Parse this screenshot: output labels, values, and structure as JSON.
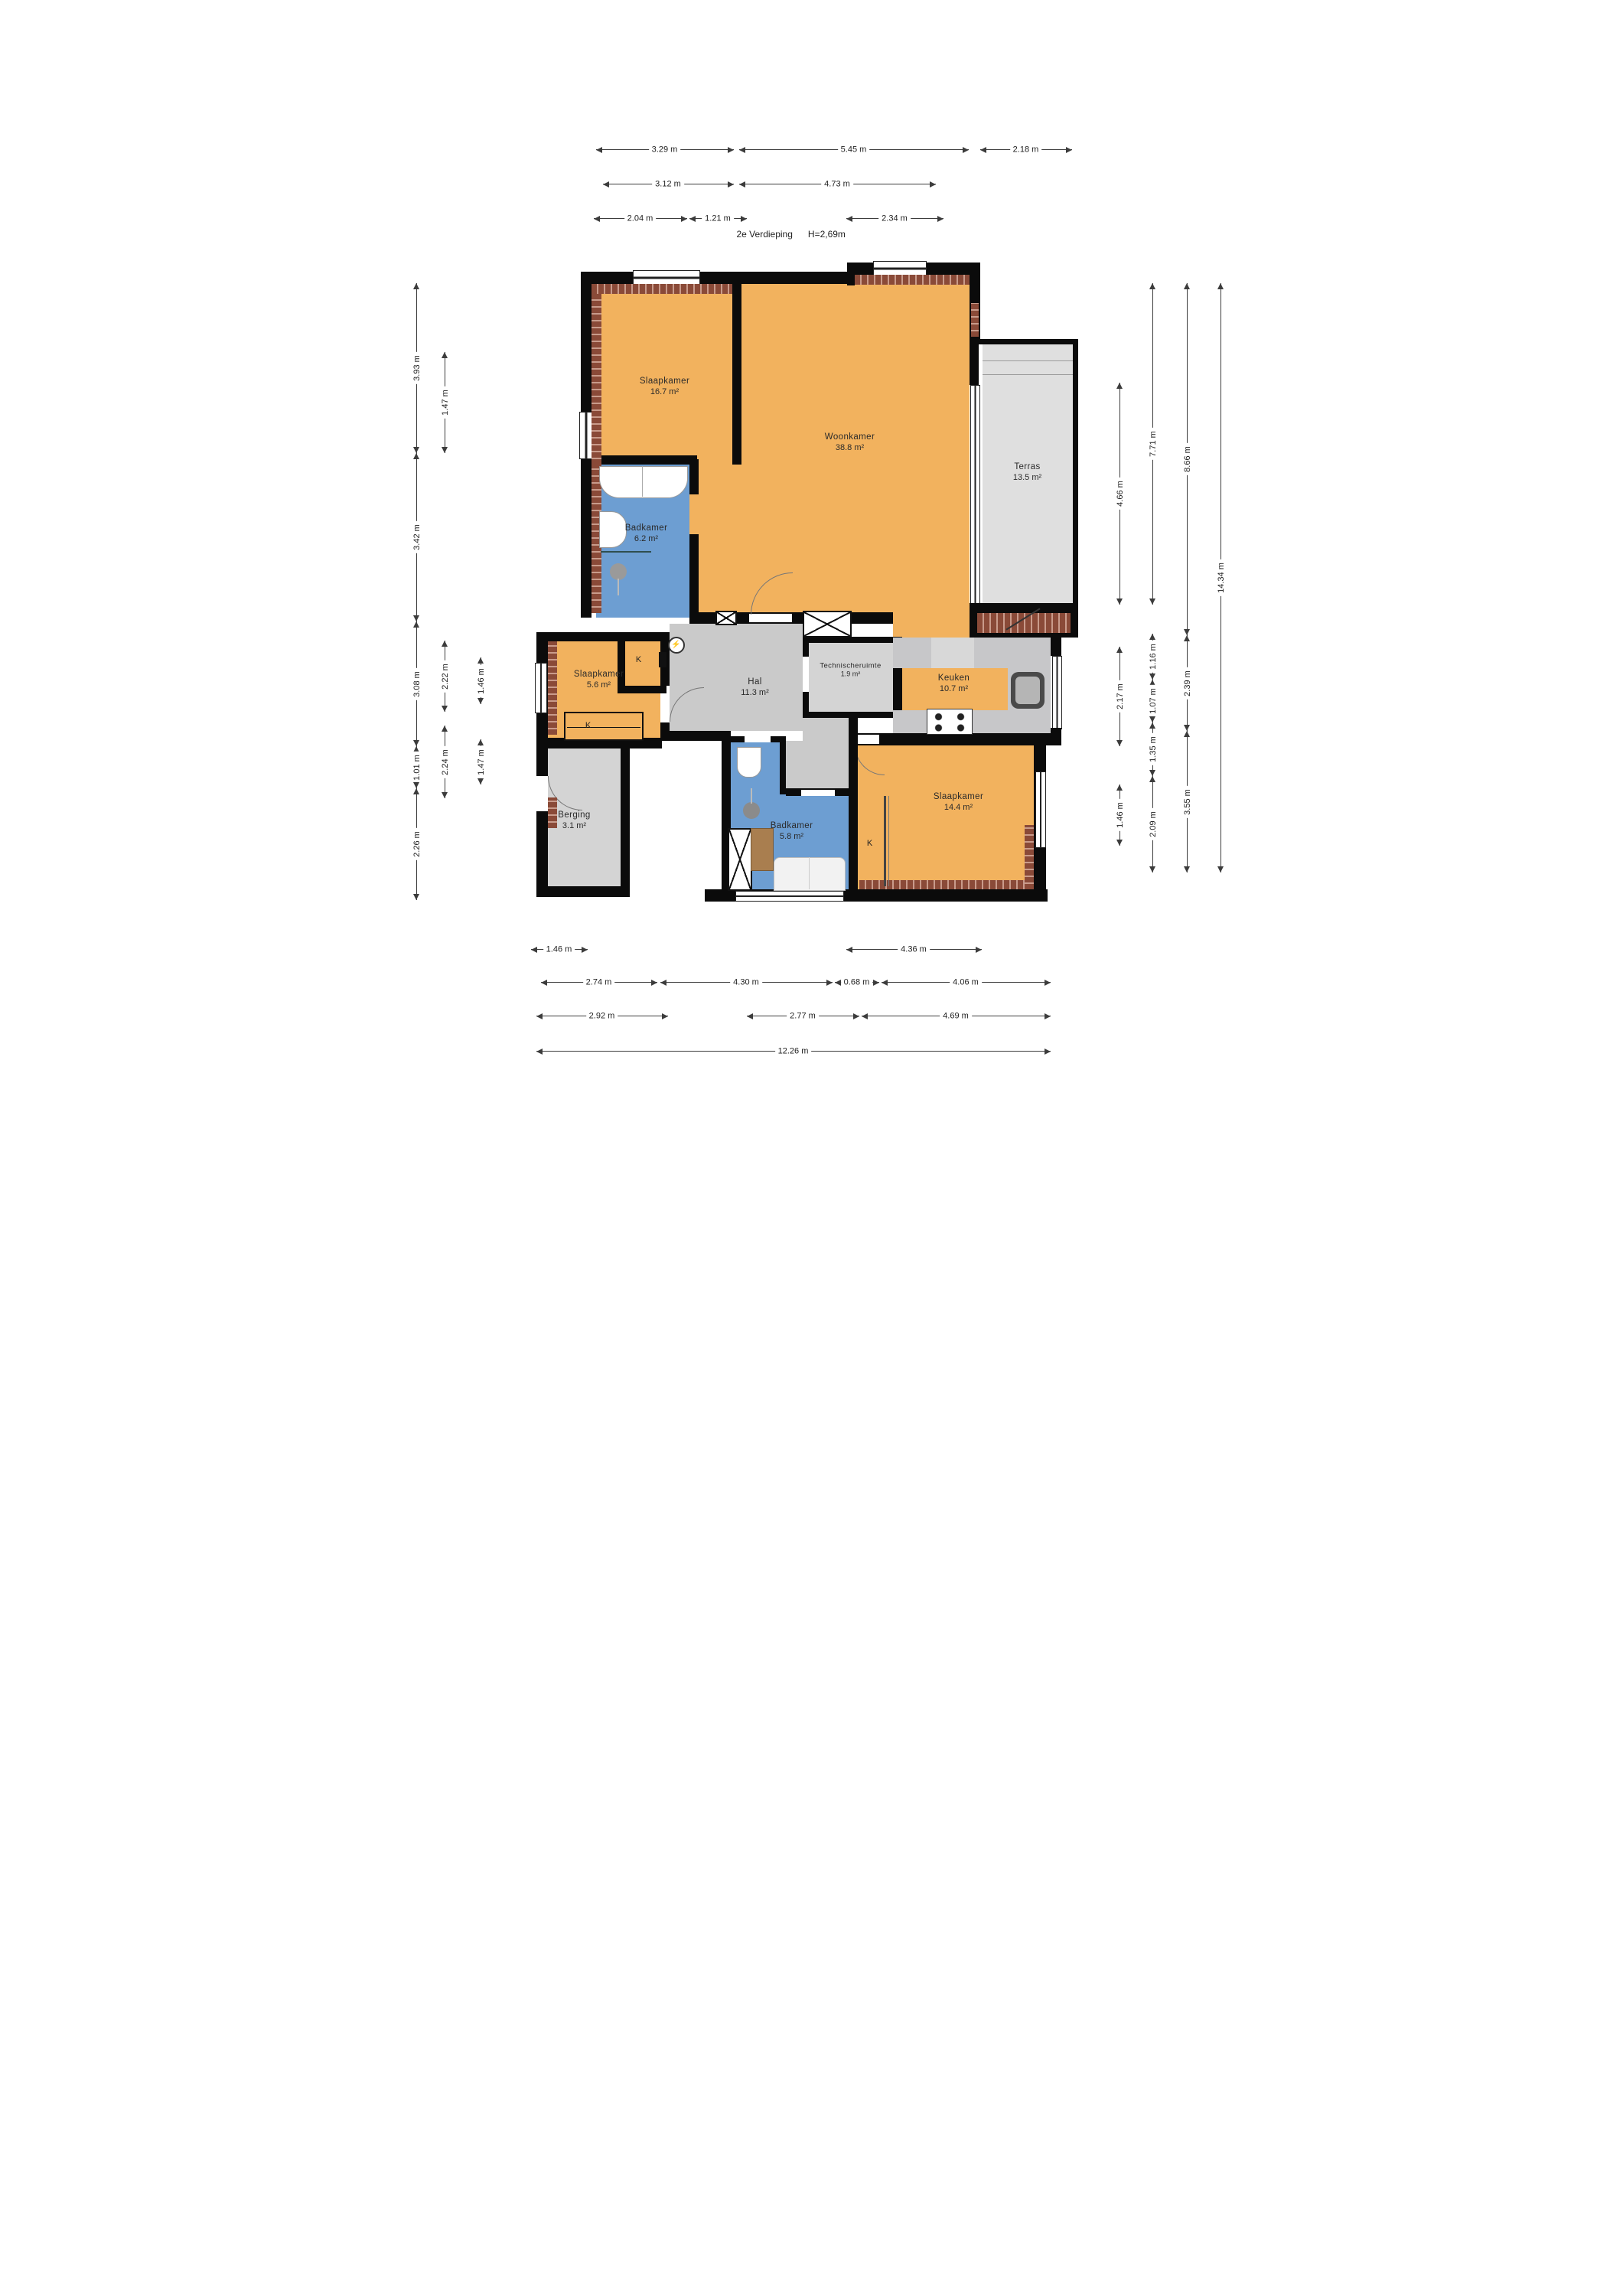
{
  "title": {
    "floor": "2e Verdieping",
    "height": "H=2,69m"
  },
  "closet": "K",
  "rooms": {
    "s1": {
      "name": "Slaapkamer",
      "area": "16.7 m²"
    },
    "woon": {
      "name": "Woonkamer",
      "area": "38.8 m²"
    },
    "terras": {
      "name": "Terras",
      "area": "13.5 m²"
    },
    "b1": {
      "name": "Badkamer",
      "area": "6.2 m²"
    },
    "s2": {
      "name": "Slaapkamer",
      "area": "5.6 m²"
    },
    "hal": {
      "name": "Hal",
      "area": "11.3 m²"
    },
    "tech": {
      "name": "Technischeruimte",
      "area": "1.9 m²"
    },
    "keuken": {
      "name": "Keuken",
      "area": "10.7 m²"
    },
    "berging": {
      "name": "Berging",
      "area": "3.1 m²"
    },
    "b2": {
      "name": "Badkamer",
      "area": "5.8 m²"
    },
    "s3": {
      "name": "Slaapkamer",
      "area": "14.4 m²"
    }
  },
  "dims": {
    "t1a": "3.29 m",
    "t1b": "5.45 m",
    "t1c": "2.18 m",
    "t2a": "3.12 m",
    "t2b": "4.73 m",
    "t3a": "2.04 m",
    "t3b": "1.21 m",
    "t3c": "2.34 m",
    "l1a": "3.93 m",
    "l1b": "3.42 m",
    "l1c": "3.08 m",
    "l1d": "1.01 m",
    "l1e": "2.26 m",
    "l2a": "1.47 m",
    "l2b": "2.22 m",
    "l2c": "2.24 m",
    "l3a": "1.46 m",
    "l3b": "1.47 m",
    "r1a": "4.66 m",
    "r1b": "2.17 m",
    "r1c": "1.46 m",
    "r2a": "7.71 m",
    "r2b": "1.16 m",
    "r2c": "1.07 m",
    "r2d": "1.35 m",
    "r2e": "2.09 m",
    "r3a": "8.66 m",
    "r3b": "2.39 m",
    "r3c": "3.55 m",
    "r4a": "14.34 m",
    "b1a": "1.46 m",
    "b1b": "4.36 m",
    "b2a": "2.74 m",
    "b2b": "4.30 m",
    "b2c": "0.68 m",
    "b2d": "4.06 m",
    "b3a": "2.92 m",
    "b3b": "2.77 m",
    "b3c": "4.69 m",
    "b4a": "12.26 m"
  },
  "icons": {
    "electric_meter": "⚡"
  },
  "colors": {
    "orange": "#F2B25E",
    "blue": "#6D9ED2",
    "hall": "#CACACA",
    "terras": "#DFDFDF",
    "store": "#D4D4D4",
    "counter": "#C7C7C9",
    "wall": "#0B0B0B",
    "brick": "#8A4A38",
    "brick_light": "#C99B8B",
    "wood": "#A97E4F",
    "dim": "#3C3C3C"
  }
}
